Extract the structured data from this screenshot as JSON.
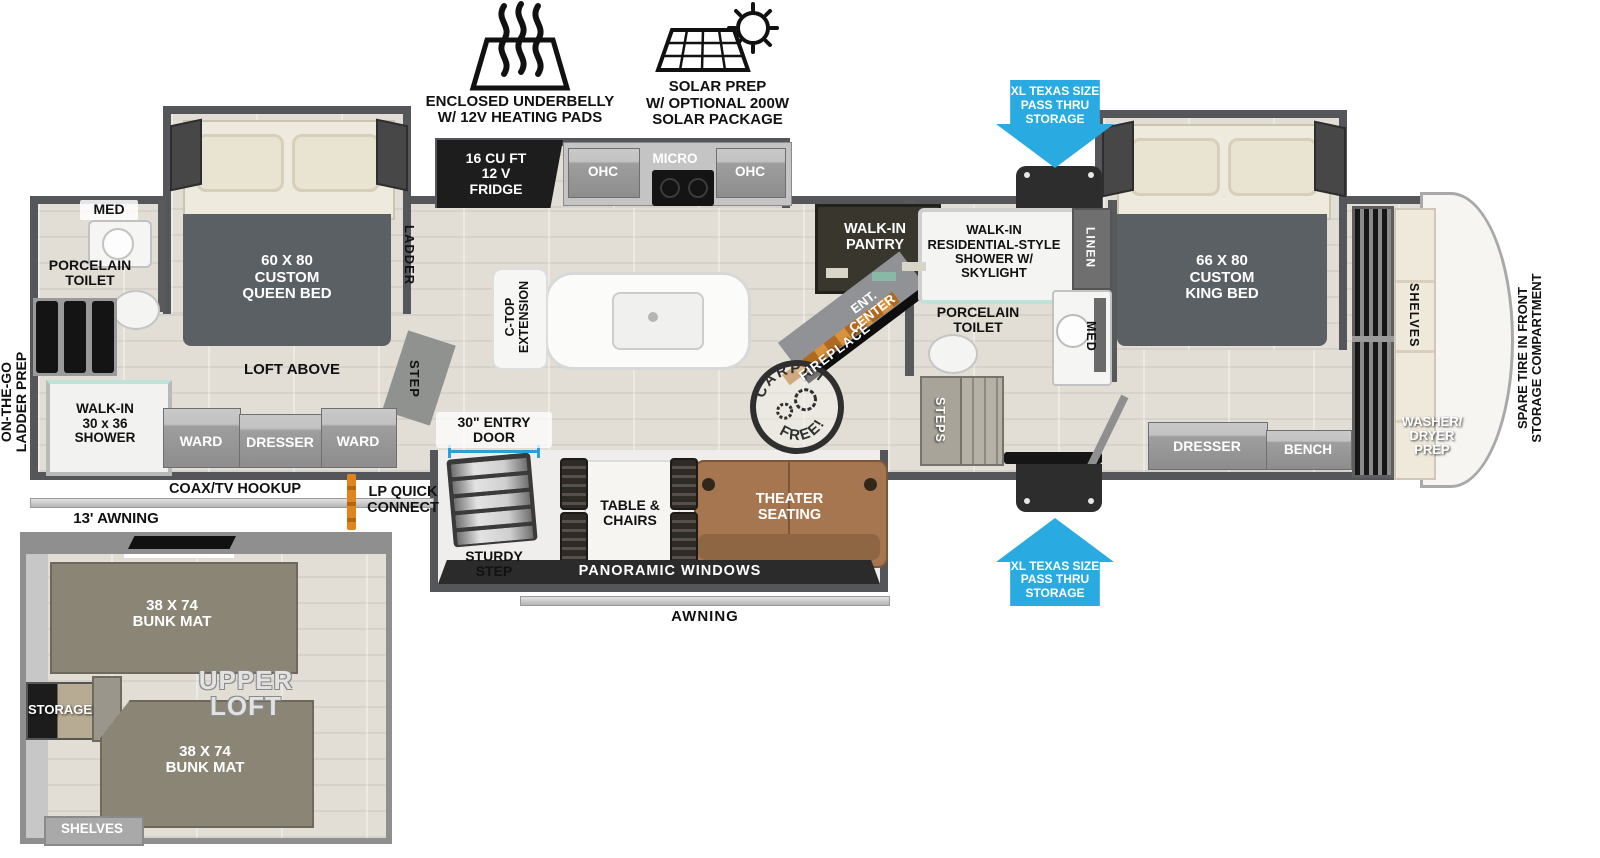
{
  "colors": {
    "accent_blue": "#29ABE2",
    "wall_gray": "#58595B",
    "theater_brown": "#A5764F"
  },
  "feature_icons": {
    "underbelly": {
      "icon": "heating-pads-icon",
      "label": "ENCLOSED UNDERBELLY\nW/ 12V HEATING PADS"
    },
    "solar": {
      "icon": "solar-panel-icon",
      "label": "SOLAR PREP\nW/ OPTIONAL 200W\nSOLAR PACKAGE"
    }
  },
  "pass_thru": {
    "top": "XL TEXAS SIZE\nPASS THRU\nSTORAGE",
    "bottom": "XL TEXAS SIZE\nPASS THRU\nSTORAGE"
  },
  "rear_bath": {
    "med": "MED",
    "toilet": "PORCELAIN\nTOILET",
    "shower": "WALK-IN\n30 x 36\nSHOWER",
    "ladder_prep": "ON-THE-GO\nLADDER PREP"
  },
  "rear_bedroom": {
    "bed": "60 X 80\nCUSTOM\nQUEEN BED",
    "loft": "LOFT ABOVE",
    "ward_left": "WARD",
    "dresser": "DRESSER",
    "ward_right": "WARD",
    "ladder": "LADDER",
    "step": "STEP"
  },
  "kitchen": {
    "fridge": "16 CU FT\n12 V\nFRIDGE",
    "ohc_left": "OHC",
    "micro": "MICRO",
    "ohc_right": "OHC",
    "island": "C-TOP\nEXTENSION",
    "pantry": "WALK-IN\nPANTRY",
    "ent_center": "ENT.\nCENTER",
    "fireplace": "FIREPLACE",
    "carpet_top": "CARPET",
    "carpet_bottom": "FREE!"
  },
  "living": {
    "entry_door": "30\" ENTRY\nDOOR",
    "sturdy_step": "STURDY\nSTEP",
    "table": "TABLE &\nCHAIRS",
    "theater": "THEATER\nSEATING",
    "windows": "PANORAMIC WINDOWS",
    "awning": "AWNING"
  },
  "exterior": {
    "coax": "COAX/TV HOOKUP",
    "lp": "LP QUICK\nCONNECT",
    "awning13": "13' AWNING"
  },
  "front_bath": {
    "shower": "WALK-IN\nRESIDENTIAL-STYLE\nSHOWER W/\nSKYLIGHT",
    "linen": "LINEN",
    "toilet": "PORCELAIN\nTOILET",
    "med": "MED",
    "steps": "STEPS"
  },
  "front_bedroom": {
    "bed": "66 X 80\nCUSTOM\nKING BED",
    "dresser": "DRESSER",
    "bench": "BENCH",
    "washer": "WASHER/\nDRYER\nPREP",
    "shelves": "SHELVES",
    "spare_tire": "SPARE TIRE IN FRONT\nSTORAGE COMPARTMENT"
  },
  "loft": {
    "title": "UPPER\nLOFT",
    "bunk_top": "38 X 74\nBUNK MAT",
    "bunk_bottom": "38 X 74\nBUNK MAT",
    "storage": "STORAGE",
    "shelves": "SHELVES"
  }
}
